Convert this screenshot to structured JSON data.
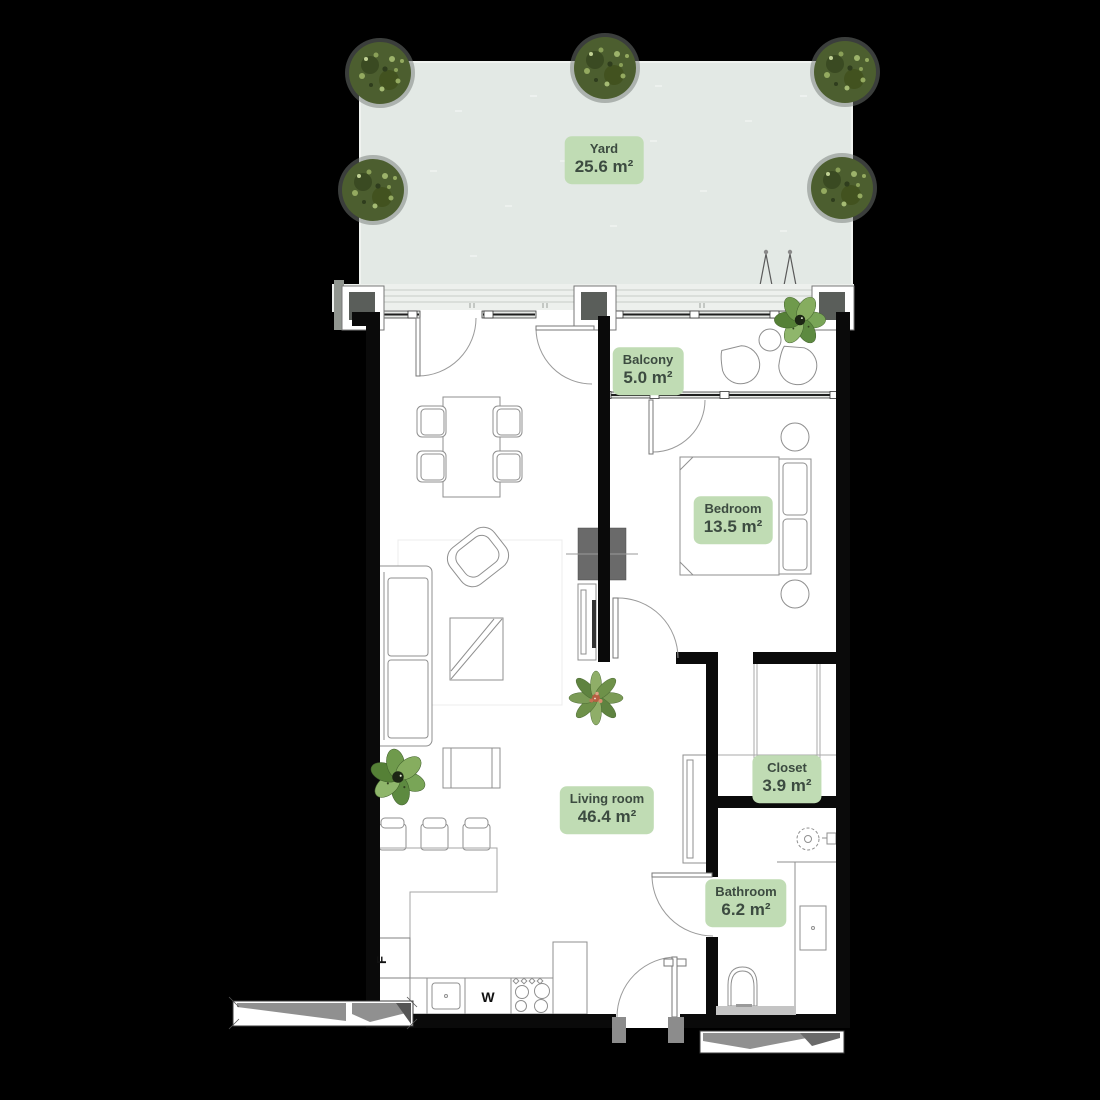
{
  "rooms": [
    {
      "id": "yard",
      "name": "Yard",
      "area": "25.6 m²"
    },
    {
      "id": "balcony",
      "name": "Balcony",
      "area": "5.0 m²"
    },
    {
      "id": "bedroom",
      "name": "Bedroom",
      "area": "13.5 m²"
    },
    {
      "id": "living-room",
      "name": "Living room",
      "area": "46.4 m²"
    },
    {
      "id": "closet",
      "name": "Closet",
      "area": "3.9 m²"
    },
    {
      "id": "bathroom",
      "name": "Bathroom",
      "area": "6.2 m²"
    }
  ],
  "appliances": {
    "fridge_label": "F",
    "washer_label": "W"
  },
  "colors": {
    "background": "#000000",
    "floor": "#ffffff",
    "wall": "#0a0a0a",
    "yard_fill": "#e3e9e5",
    "facade_band": "#edf0ed",
    "label_bg": "#c0dcb4",
    "label_text": "#3c4b40",
    "tree_foliage": "#4c5e2f",
    "tree_highlight": "#9db36b",
    "plant_green": "#6f9a4c",
    "furniture_line": "#8f8f8f",
    "shaft_gray": "#6a6a6a",
    "ramp_gray": "#909090"
  }
}
